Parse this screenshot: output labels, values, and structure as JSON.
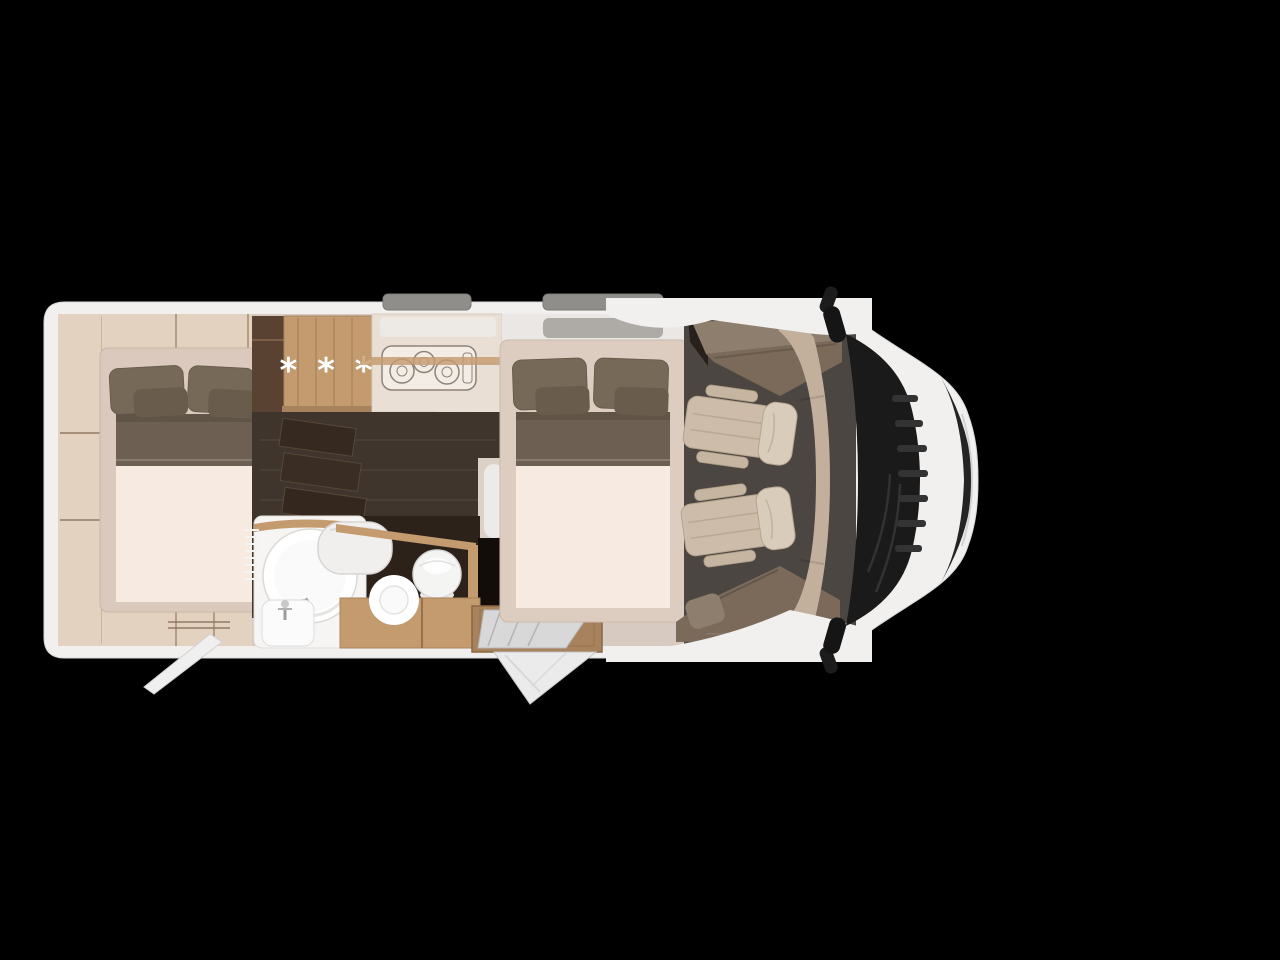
{
  "wardrobe": {
    "symbol": "* * *"
  },
  "colors": {
    "bg": "#000000",
    "body": "#f1f0ef",
    "skylight": "#908e8b",
    "interior": "#d7cbc1",
    "woodpale": "#e4d2c0",
    "wood": "#c49b6f",
    "woodbase": "#a8825d",
    "mattress": "#f7eae1",
    "blanket": "#6d5f52",
    "pillow": "#776958",
    "pillowsmall": "#695c4c",
    "floordark": "#3f352d",
    "walldark": "#2c221a",
    "loungefloor": "#4b4642",
    "bench": "#7b6a5a",
    "benchback": "#8e7e6d",
    "chair": "#ccbca9",
    "chairlight": "#d9ccba",
    "tan": "#c2b09d",
    "windshield": "#1a1a1a",
    "grille": "#242424",
    "counter": "#e9dfd5",
    "star": "#ffffff"
  }
}
